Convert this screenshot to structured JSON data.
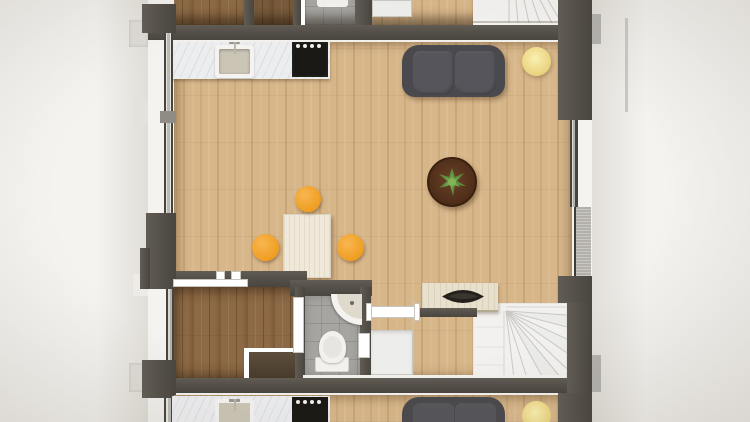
{
  "scene": {
    "type": "3d-rendered-floor-plan",
    "view": "top-down",
    "units_visible": 3,
    "middle_unit_rooms": [
      "open-living-room",
      "kitchen",
      "dining-area",
      "entrance-hall",
      "bathroom",
      "utility-area",
      "staircase"
    ],
    "furniture_and_fixtures": [
      "kitchen-counter-with-sink-and-faucet",
      "four-burner-cooktop",
      "two-seat-sofa",
      "round-yellow-side-table",
      "round-walnut-coffee-table-with-plant",
      "dining-table",
      "orange-dining-chair",
      "orange-dining-chair",
      "orange-dining-chair",
      "sideboard-with-black-decor-bowl",
      "washing-machine",
      "corner-washbasin",
      "toilet",
      "winder-staircase"
    ]
  },
  "colors": {
    "background": "#f4f3f0",
    "wall": "#56524b",
    "wall_dark": "#49453f",
    "floor_oak": "#d7b689",
    "floor_walnut": "#8d6a45",
    "tile": "#a7a5a1",
    "marble": "#ecedef",
    "sink_bowl": "#cbc5b6",
    "fixture_white": "#f4f3f0",
    "cooktop": "#1a1814",
    "knob": "#f0efec",
    "sofa": "#4a494d",
    "sofa_cushion": "#56555b",
    "pouf": "#e8d07a",
    "pouf_hi": "#f9f0b0",
    "coffee_table": "#52301b",
    "coffee_table_dark": "#3c2110",
    "plant": "#5d8c3e",
    "plant_hi": "#82b457",
    "dining_table": "#f0e9da",
    "chair": "#ef9d20",
    "chair_hi": "#f8b650",
    "stairs": "#f2f1ef",
    "stair_line": "#c9c8c4",
    "sideboard": "#e7e0cd",
    "sideboard_edge": "#b5ab92",
    "bowl": "#24211c",
    "door_white": "#ffffff",
    "door_line": "#c7c5c0",
    "threshold": "#b3b0aa",
    "shutter": "#dcdad4",
    "washer": "#ededeb",
    "washer_line": "#c9c8c4",
    "toilet_white": "#f2f1ee"
  }
}
